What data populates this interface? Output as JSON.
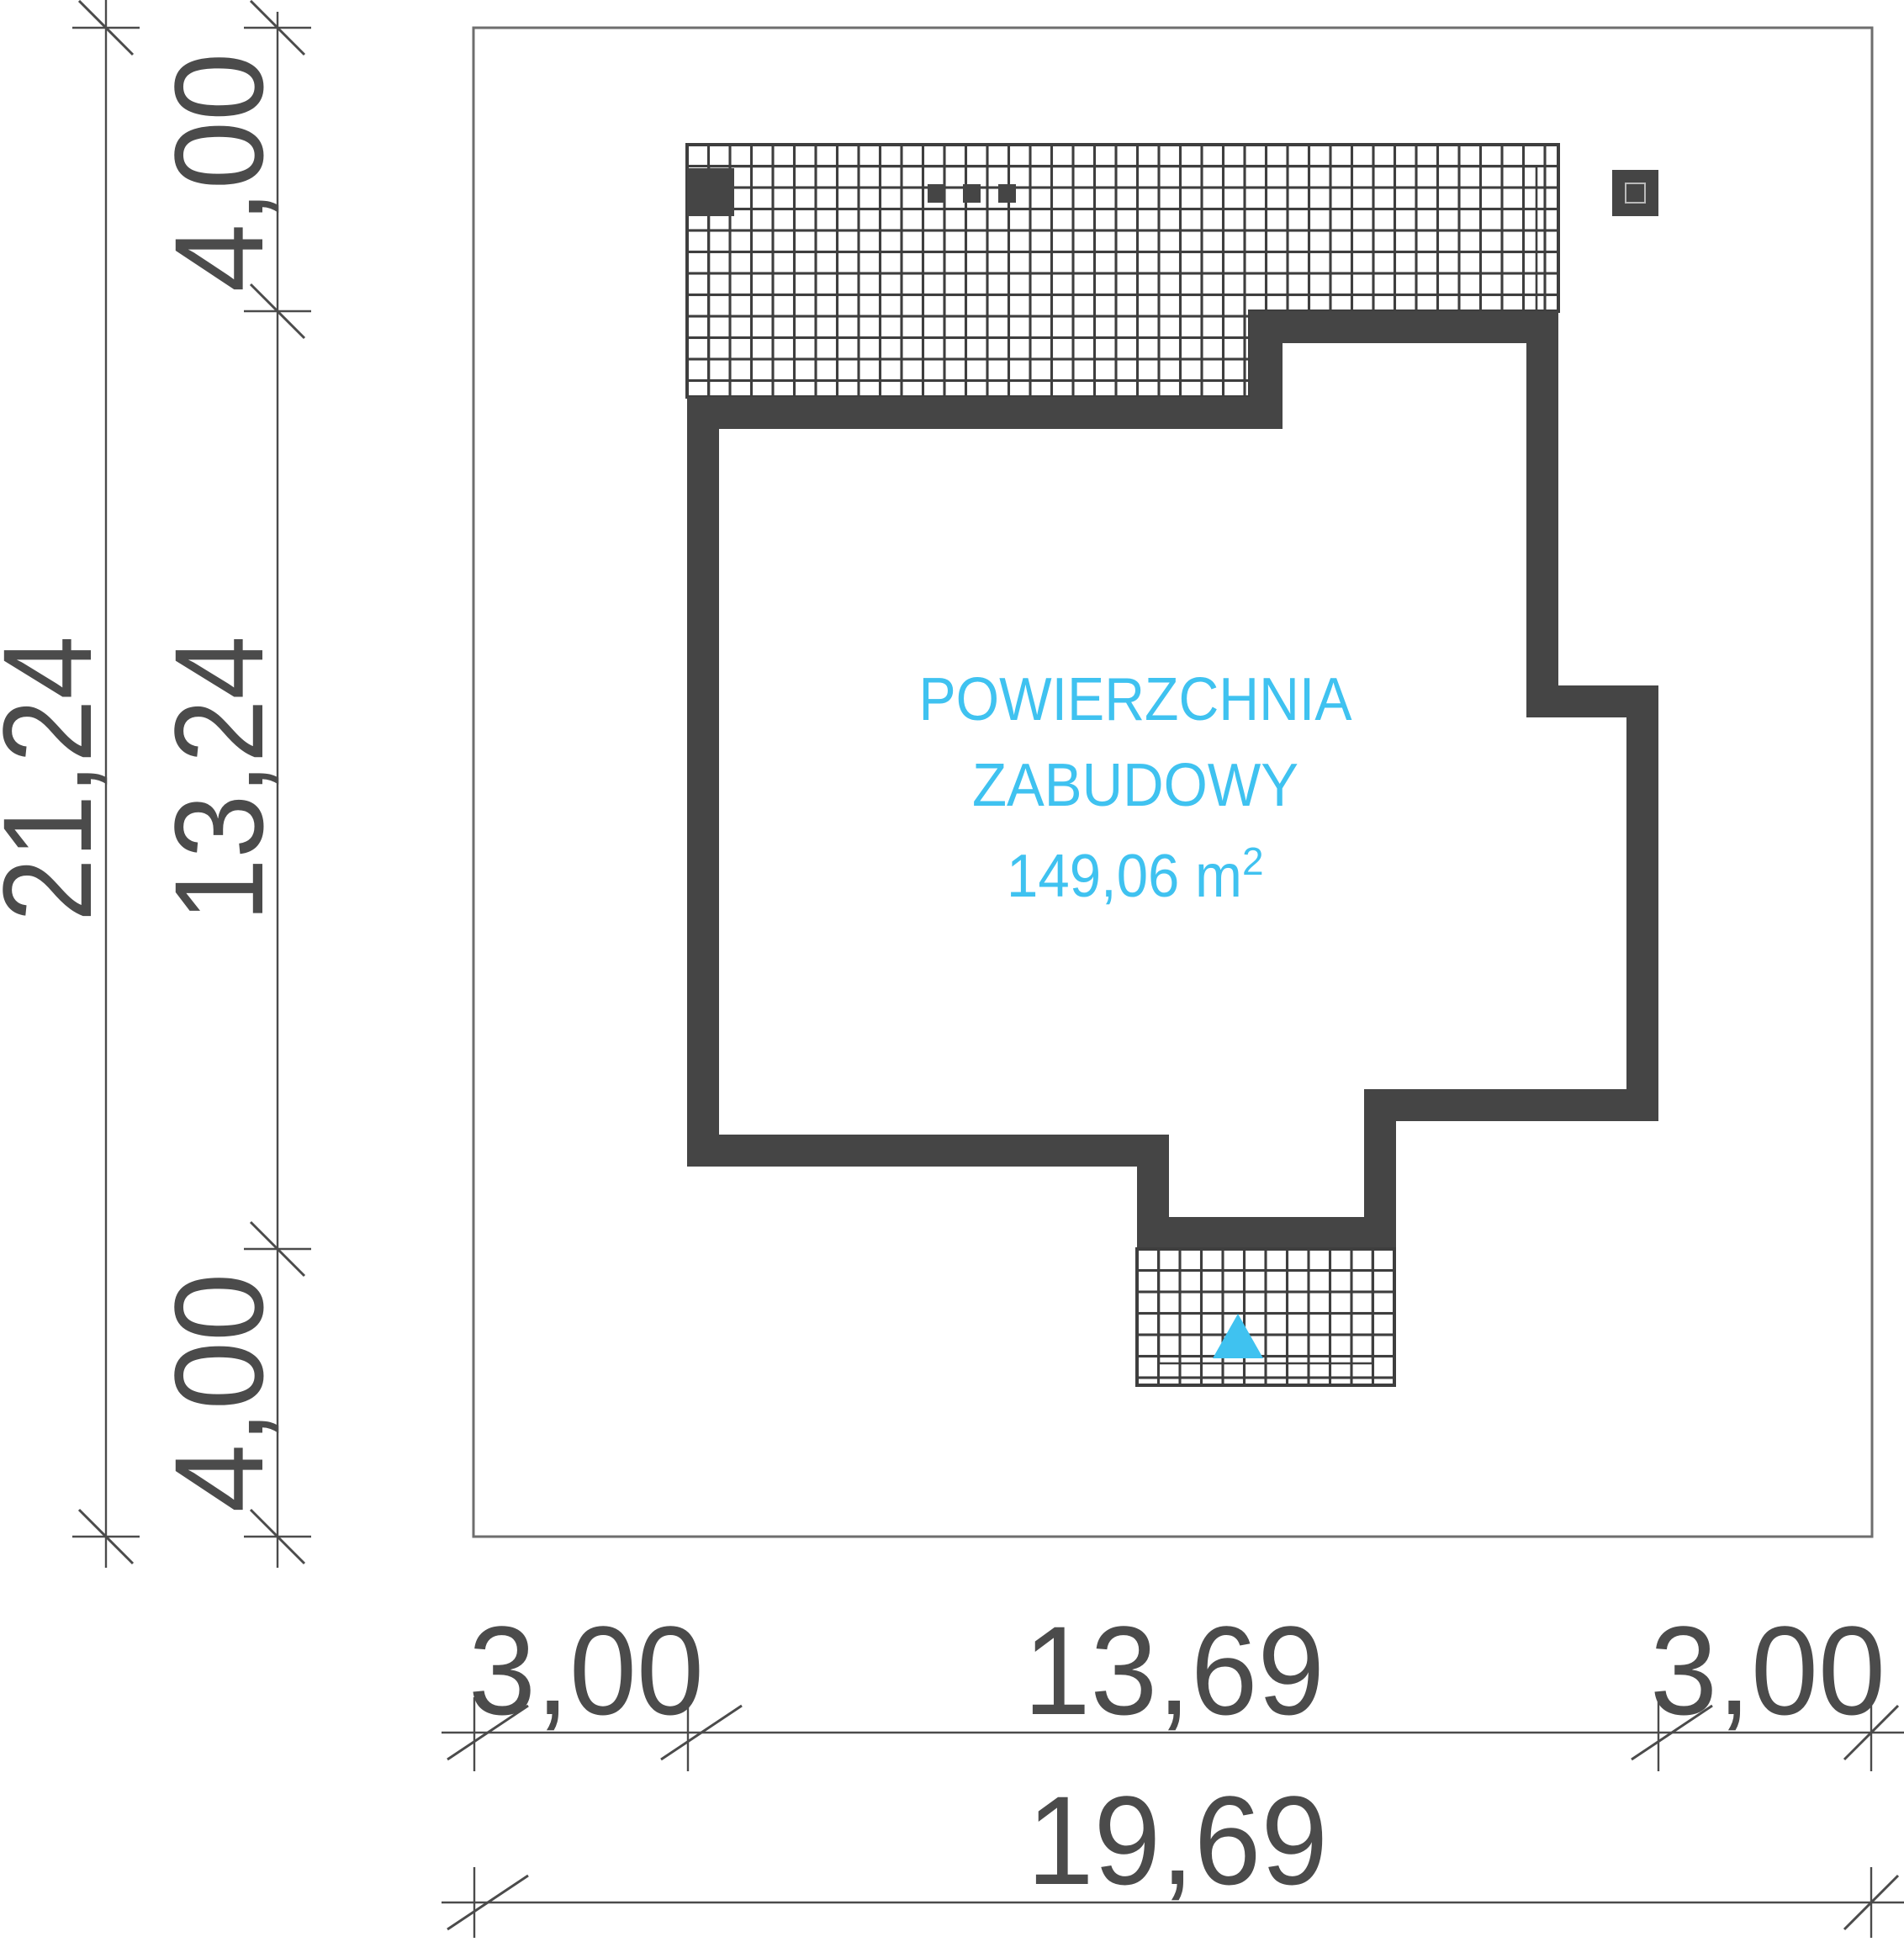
{
  "area_label": {
    "line1": "POWIERZCHNIA",
    "line2": "ZABUDOWY",
    "value": "149,06 m",
    "value_sup": "2"
  },
  "dimensions": {
    "left_total": "21,24",
    "left_top": "4,00",
    "left_middle": "13,24",
    "left_bottom": "4,00",
    "bottom_left": "3,00",
    "bottom_middle": "13,69",
    "bottom_right": "3,00",
    "bottom_total": "19,69"
  },
  "colors": {
    "wall": "#454545",
    "interior": "#ffffff",
    "hatch": "#3e3e3e",
    "plot_line": "#6e6e6e",
    "dimension": "#4b4b4b",
    "accent": "#3fc2f0",
    "inner_outline": "#b9b9b9"
  }
}
